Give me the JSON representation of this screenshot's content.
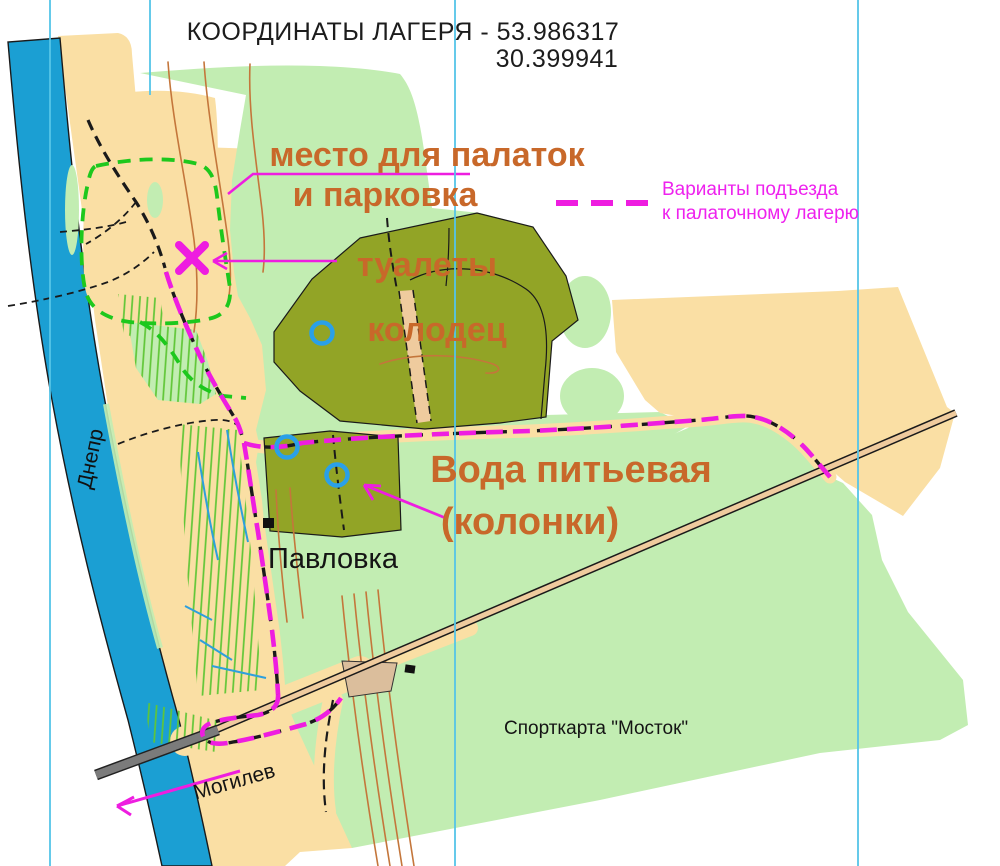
{
  "title": {
    "line1": "КООРДИНАТЫ  ЛАГЕРЯ - 53.986317",
    "line2": "30.399941"
  },
  "coordinates": {
    "lat": "53.986317",
    "lon": "30.399941"
  },
  "legend": {
    "swatch": "magenta-dashed-line",
    "line1": "Варианты подъезда",
    "line2": "к палаточному лагерю"
  },
  "annotations": {
    "camp_line1": "место для палаток",
    "camp_line2": "и парковка",
    "toilets": "туалеты",
    "well": "колодец",
    "water_line1": "Вода питьевая",
    "water_line2": "(колонки)"
  },
  "places": {
    "river": "Днепр",
    "village": "Павловка",
    "city_direction": "Могилев",
    "map_credit": "Спорткарта \"Мосток\""
  },
  "symbols": {
    "x_marker": "toilets-location-x",
    "well_circles_count": 3,
    "camp_boundary": "green-dashed-outline",
    "access_route": "magenta-dashed-route"
  },
  "colors": {
    "open_land": "#FADFA4",
    "open_forest": "#C2EDB2",
    "cultivated": "#92A426",
    "water": "#1B9FD3",
    "route_magenta": "#EE1DE0",
    "label_orange": "#C8682A",
    "contour_brown": "#C4763B",
    "registration_blue": "#55C5E8",
    "road_fill": "#EFCB9E",
    "bridge_gray": "#7B7B7B",
    "camp_dash_green": "#1DC81D"
  }
}
